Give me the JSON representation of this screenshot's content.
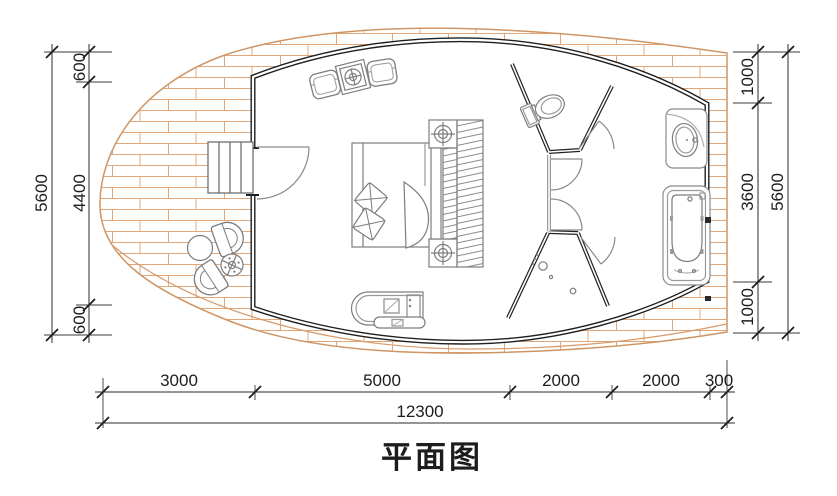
{
  "title": {
    "text": "平面图"
  },
  "colors": {
    "deck_line": "#d99a6a",
    "wall": "#1f1f1f",
    "partition_light": "#9a9a9a",
    "furniture_line": "#7d7d7d",
    "dim_line": "#2b2b2b"
  },
  "dimensions": {
    "left": {
      "overall": "5600",
      "segments": [
        "600",
        "4400",
        "600"
      ]
    },
    "right": {
      "overall": "5600",
      "segments": [
        "1000",
        "3600",
        "1000"
      ]
    },
    "bottom": {
      "overall": "12300",
      "segments": [
        "3000",
        "5000",
        "2000",
        "2000",
        "300"
      ]
    }
  },
  "fixtures": {
    "entry": "stairs-and-door",
    "bedroom": [
      "seating-chairs",
      "side-table",
      "double-bed",
      "pillows",
      "nightstand-lamps",
      "wardrobe",
      "console"
    ],
    "wet_rooms": [
      "toilet",
      "shower",
      "vanity-sink",
      "bathtub"
    ],
    "deck": [
      "outdoor-chairs",
      "round-table",
      "heater-table"
    ]
  }
}
